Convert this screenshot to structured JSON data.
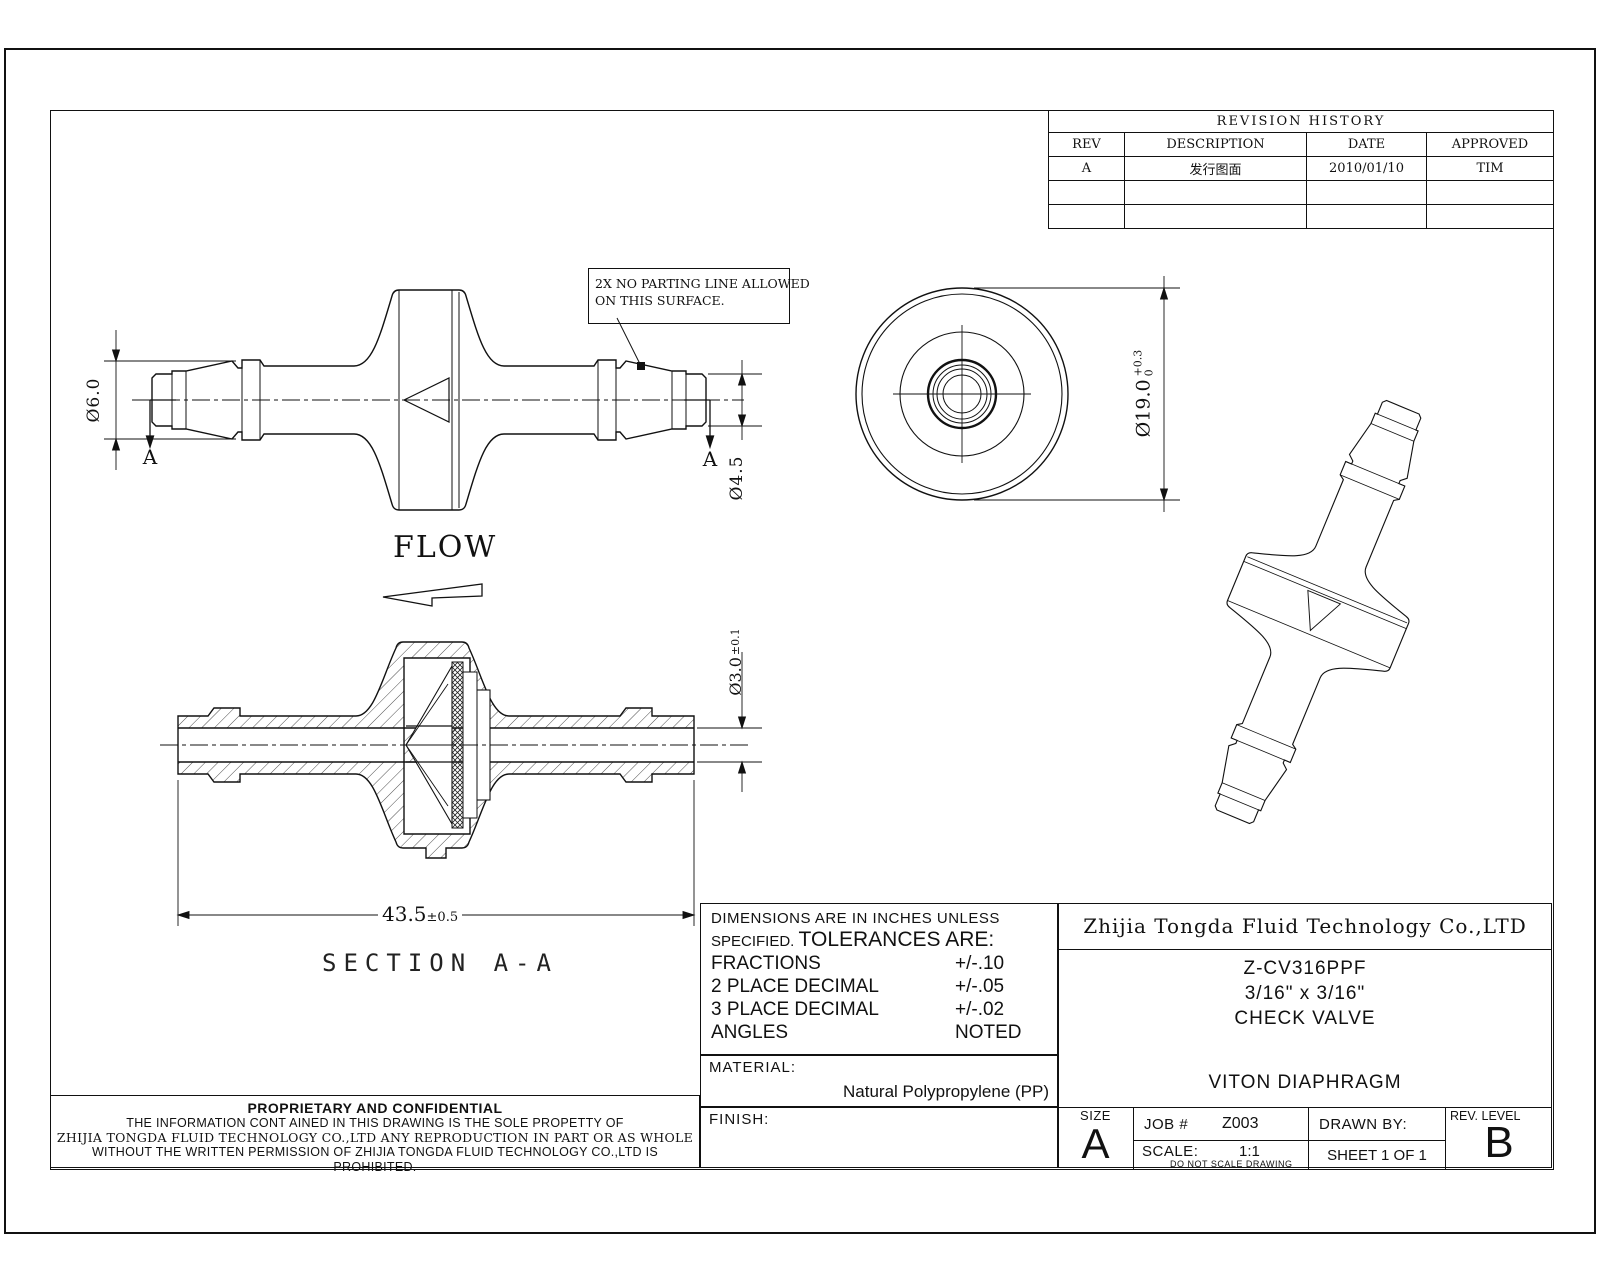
{
  "revision_table": {
    "title": "REVISION HISTORY",
    "headers": [
      "REV",
      "DESCRIPTION",
      "DATE",
      "APPROVED"
    ],
    "rows": [
      [
        "A",
        "发行图面",
        "2010/01/10",
        "TIM"
      ],
      [
        "",
        "",
        "",
        ""
      ],
      [
        "",
        "",
        "",
        ""
      ]
    ]
  },
  "annotations": {
    "note_line1": "2X NO PARTING LINE ALLOWED",
    "note_line2": "ON THIS SURFACE.",
    "flow_label": "FLOW",
    "section_label": "SECTION A-A",
    "cut_letter_left": "A",
    "cut_letter_right": "A"
  },
  "dimensions": {
    "dia6": "Ø6.0",
    "dia45": "Ø4.5",
    "dia19": "Ø19.0",
    "dia19_tol_upper": "+0.3",
    "dia19_tol_lower": "0",
    "dia3": "Ø3.0",
    "dia3_tol": "±0.1",
    "length": "43.5",
    "length_tol": "±0.5"
  },
  "tolerance_block": {
    "line1": "DIMENSIONS ARE IN INCHES UNLESS",
    "line2_small": "SPECIFIED.",
    "line2_large": "TOLERANCES ARE:",
    "rows": [
      {
        "label": "FRACTIONS",
        "value": "+/-.10"
      },
      {
        "label": "2 PLACE DECIMAL",
        "value": "+/-.05"
      },
      {
        "label": "3 PLACE DECIMAL",
        "value": "+/-.02"
      },
      {
        "label": "ANGLES",
        "value": "NOTED"
      }
    ]
  },
  "material_block": {
    "label": "MATERIAL:",
    "value": "Natural Polypropylene (PP)"
  },
  "finish_block": {
    "label": "FINISH:"
  },
  "title_block": {
    "company": "Zhijia Tongda Fluid Technology Co.,LTD",
    "part_number": "Z-CV316PPF",
    "size_spec": "3/16\" x 3/16\"",
    "part_name": "CHECK VALVE",
    "subtitle": "VITON DIAPHRAGM",
    "size_label": "SIZE",
    "size_value": "A",
    "job_label": "JOB #",
    "job_value": "Z003",
    "drawn_by_label": "DRAWN BY:",
    "scale_label": "SCALE:",
    "scale_value": "1:1",
    "no_scale_note": "DO NOT SCALE DRAWING",
    "sheet_label": "SHEET  1 OF 1",
    "rev_level_label": "REV. LEVEL",
    "rev_level_value": "B"
  },
  "proprietary": {
    "title": "PROPRIETARY AND CONFIDENTIAL",
    "line1": "THE INFORMATION CONT AINED IN THIS DRAWING IS THE SOLE PROPETTY OF",
    "line2": "ZHIJIA TONGDA FLUID TECHNOLOGY CO.,LTD ANY REPRODUCTION IN PART OR AS WHOLE",
    "line3": "WITHOUT THE WRITTEN PERMISSION OF   ZHIJIA TONGDA FLUID TECHNOLOGY CO.,LTD IS PROHIBITED."
  }
}
